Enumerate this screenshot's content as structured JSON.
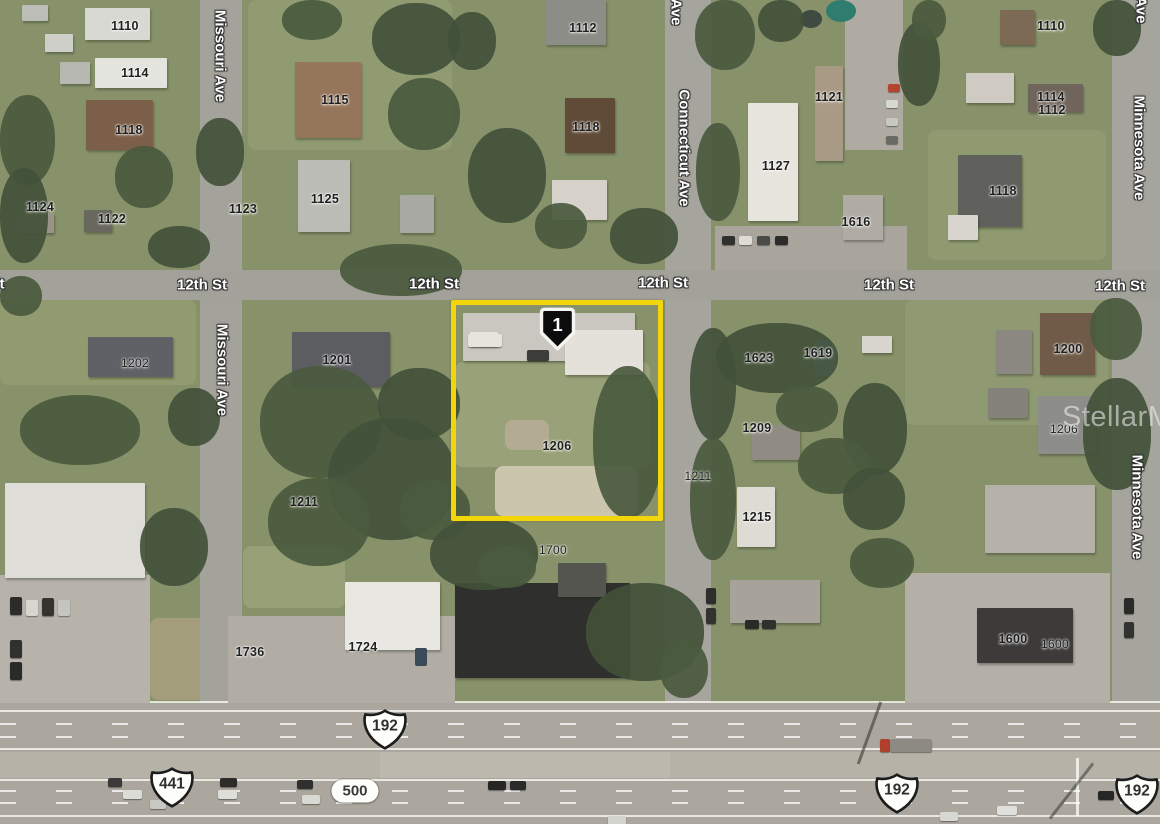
{
  "map": {
    "watermark": "StellarMLS",
    "marker": {
      "label": "1"
    },
    "selected_parcel": "1206",
    "highlight_color": "#F2D50B",
    "street_labels_horizontal": [
      {
        "text": "St",
        "x": -3,
        "y": 284
      },
      {
        "text": "12th St",
        "x": 202,
        "y": 285
      },
      {
        "text": "12th St",
        "x": 434,
        "y": 284
      },
      {
        "text": "12th St",
        "x": 663,
        "y": 283
      },
      {
        "text": "12th St",
        "x": 889,
        "y": 285
      },
      {
        "text": "12th St",
        "x": 1120,
        "y": 286
      }
    ],
    "street_labels_vertical": [
      {
        "text": "Ave",
        "x": 676,
        "y": 12
      },
      {
        "text": "Ave",
        "x": 1141,
        "y": 10
      },
      {
        "text": "Missouri Ave",
        "x": 220,
        "y": 56
      },
      {
        "text": "Missouri Ave",
        "x": 222,
        "y": 370
      },
      {
        "text": "Connecticut Ave",
        "x": 684,
        "y": 148
      },
      {
        "text": "Minnesota Ave",
        "x": 1139,
        "y": 148
      },
      {
        "text": "Minnesota Ave",
        "x": 1137,
        "y": 507
      }
    ],
    "parcel_labels": [
      {
        "text": "1110",
        "x": 125,
        "y": 26
      },
      {
        "text": "1114",
        "x": 135,
        "y": 73
      },
      {
        "text": "1118",
        "x": 129,
        "y": 130
      },
      {
        "text": "1124",
        "x": 40,
        "y": 207
      },
      {
        "text": "1122",
        "x": 112,
        "y": 219
      },
      {
        "text": "1123",
        "x": 243,
        "y": 209
      },
      {
        "text": "1115",
        "x": 335,
        "y": 100
      },
      {
        "text": "1125",
        "x": 325,
        "y": 199
      },
      {
        "text": "1112",
        "x": 583,
        "y": 28
      },
      {
        "text": "1118",
        "x": 586,
        "y": 127
      },
      {
        "text": "1121",
        "x": 829,
        "y": 97
      },
      {
        "text": "1127",
        "x": 776,
        "y": 166
      },
      {
        "text": "1616",
        "x": 856,
        "y": 222
      },
      {
        "text": "1110",
        "x": 1051,
        "y": 26
      },
      {
        "text": "1114",
        "x": 1051,
        "y": 97
      },
      {
        "text": "1112",
        "x": 1052,
        "y": 110
      },
      {
        "text": "1118",
        "x": 1003,
        "y": 191
      },
      {
        "text": "1202",
        "x": 135,
        "y": 363,
        "light": true
      },
      {
        "text": "1201",
        "x": 337,
        "y": 360
      },
      {
        "text": "1206",
        "x": 557,
        "y": 446
      },
      {
        "text": "1623",
        "x": 759,
        "y": 358
      },
      {
        "text": "1619",
        "x": 818,
        "y": 353
      },
      {
        "text": "1209",
        "x": 757,
        "y": 428
      },
      {
        "text": "1211",
        "x": 698,
        "y": 476,
        "light": true
      },
      {
        "text": "1200",
        "x": 1068,
        "y": 349
      },
      {
        "text": "1206",
        "x": 1064,
        "y": 429,
        "light": true
      },
      {
        "text": "1211",
        "x": 304,
        "y": 502
      },
      {
        "text": "1215",
        "x": 757,
        "y": 517
      },
      {
        "text": "1700",
        "x": 553,
        "y": 550,
        "light": true
      },
      {
        "text": "1736",
        "x": 250,
        "y": 652
      },
      {
        "text": "1724",
        "x": 363,
        "y": 647
      },
      {
        "text": "1600",
        "x": 1013,
        "y": 639
      },
      {
        "text": "1600",
        "x": 1055,
        "y": 644,
        "light": true
      }
    ],
    "highway_shields": [
      {
        "shape": "us",
        "text": "192",
        "x": 385,
        "y": 732
      },
      {
        "shape": "us",
        "text": "441",
        "x": 172,
        "y": 790
      },
      {
        "shape": "pill",
        "text": "500",
        "x": 355,
        "y": 791
      },
      {
        "shape": "us",
        "text": "192",
        "x": 897,
        "y": 796
      },
      {
        "shape": "us",
        "text": "192",
        "x": 1137,
        "y": 797
      }
    ]
  }
}
